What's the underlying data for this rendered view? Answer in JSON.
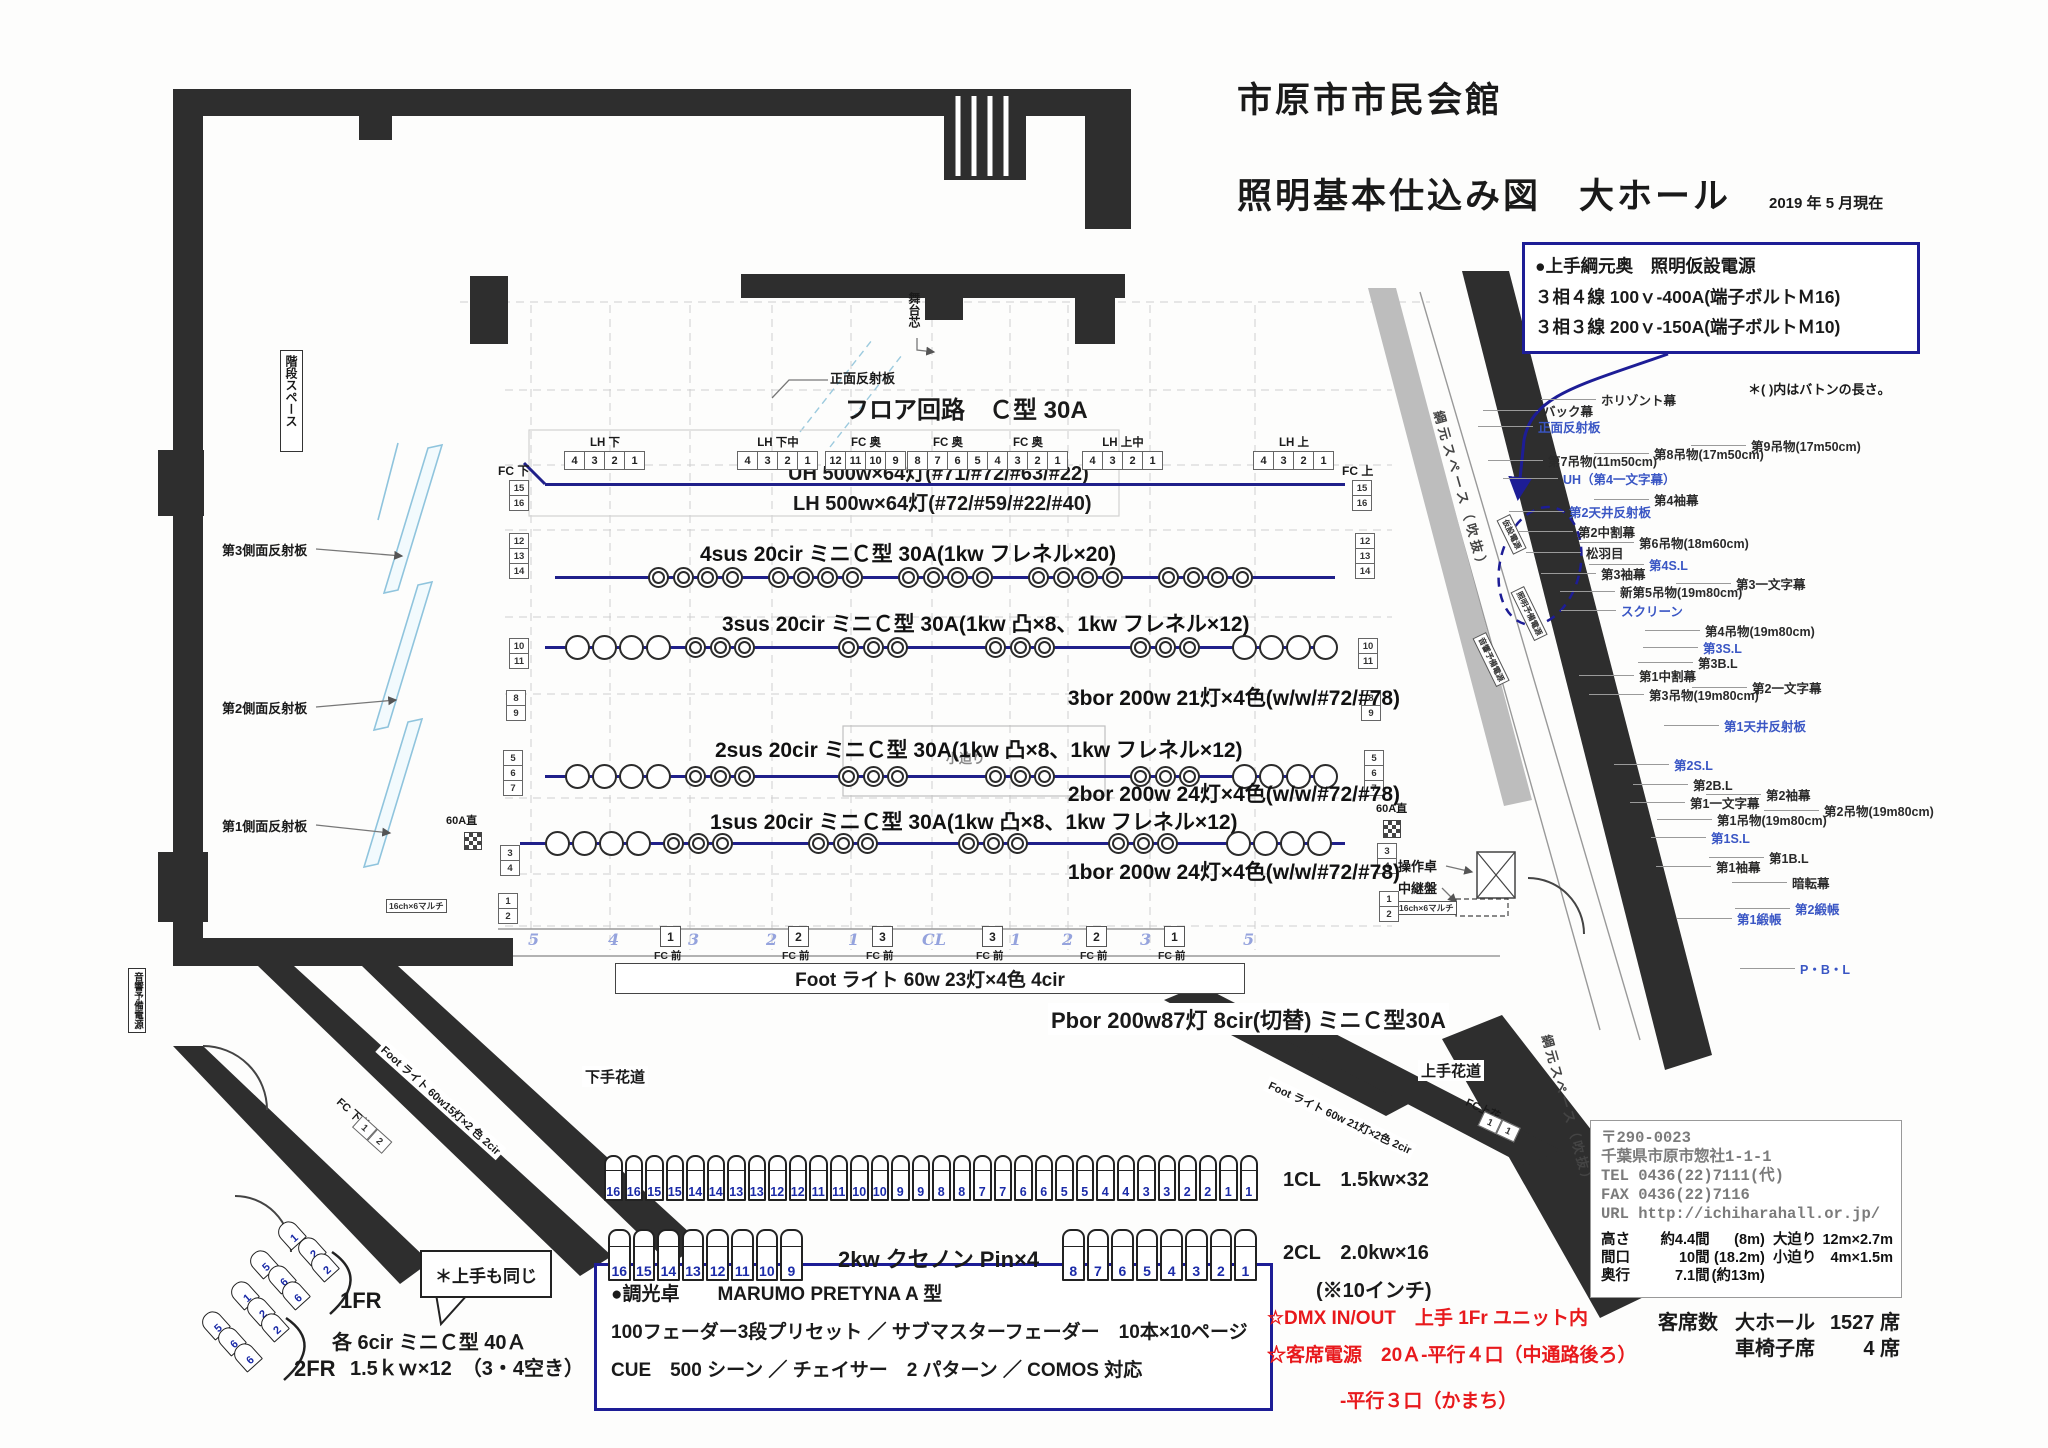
{
  "title": {
    "line1": "市原市市民会館",
    "line2": "照明基本仕込み図　大ホール",
    "date": "2019 年 5 月現在"
  },
  "power_box": {
    "line1": "●上手綱元奥　照明仮設電源",
    "line2": "３相４線 100ｖ-400A(端子ボルトＭ16)",
    "line3": "３相３線 200ｖ-150A(端子ボルトＭ10)"
  },
  "batten_note": "＊( )内はバトンの長さ。",
  "battens": [
    {
      "t": "ホリゾント幕",
      "c": "k"
    },
    {
      "t": "バック幕",
      "c": "k"
    },
    {
      "t": "正面反射板",
      "c": "b"
    },
    {
      "t": "第9吊物(17m50cm)",
      "c": "k"
    },
    {
      "t": "第8吊物(17m50cm)",
      "c": "k"
    },
    {
      "t": "第7吊物(11m50cm)",
      "c": "k"
    },
    {
      "t": "UH（第4一文字幕）",
      "c": "b"
    },
    {
      "t": "第4袖幕",
      "c": "k"
    },
    {
      "t": "第2天井反射板",
      "c": "b"
    },
    {
      "t": "第2中割幕",
      "c": "k"
    },
    {
      "t": "第6吊物(18m60cm)",
      "c": "k"
    },
    {
      "t": "松羽目",
      "c": "k"
    },
    {
      "t": "第4S.L",
      "c": "b"
    },
    {
      "t": "第3袖幕",
      "c": "k"
    },
    {
      "t": "第3一文字幕",
      "c": "k"
    },
    {
      "t": "新第5吊物(19m80cm)",
      "c": "k"
    },
    {
      "t": "スクリーン",
      "c": "b"
    },
    {
      "t": "第4吊物(19m80cm)",
      "c": "k"
    },
    {
      "t": "第3S.L",
      "c": "b"
    },
    {
      "t": "第3B.L",
      "c": "k"
    },
    {
      "t": "第1中割幕",
      "c": "k"
    },
    {
      "t": "第2一文字幕",
      "c": "k"
    },
    {
      "t": "第3吊物(19m80cm)",
      "c": "k"
    },
    {
      "t": "第1天井反射板",
      "c": "b"
    },
    {
      "t": "第2S.L",
      "c": "b"
    },
    {
      "t": "第2B.L",
      "c": "k"
    },
    {
      "t": "第2袖幕",
      "c": "k"
    },
    {
      "t": "第1一文字幕",
      "c": "k"
    },
    {
      "t": "第2吊物(19m80cm)",
      "c": "k"
    },
    {
      "t": "第1吊物(19m80cm)",
      "c": "k"
    },
    {
      "t": "第1S.L",
      "c": "b"
    },
    {
      "t": "第1B.L",
      "c": "k"
    },
    {
      "t": "第1袖幕",
      "c": "k"
    },
    {
      "t": "暗転幕",
      "c": "k"
    },
    {
      "t": "第2緞帳",
      "c": "b"
    },
    {
      "t": "第1緞帳",
      "c": "b"
    },
    {
      "t": "P・B・L",
      "c": "b"
    }
  ],
  "stage": {
    "floor_circuit": "フロア回路　Ｃ型 30A",
    "front_reflector": "正面反射板",
    "stage_center": "舞台芯",
    "fc_down": "FC 下",
    "fc_up": "FC 上",
    "uh_label": "UH 500w×64灯(#71/#72/#63/#22)",
    "lh_label": "LH 500w×64灯(#72/#59/#22/#40)",
    "sus_bars": [
      {
        "label": "4sus 20cir ミニＣ型 30A(1kw フレネル×20)",
        "fixtures": [
          "F4",
          "F4",
          "F4",
          "F4",
          "F4"
        ]
      },
      {
        "label": "3sus 20cir ミニＣ型 30A(1kw 凸×8、1kw フレネル×12)",
        "fixtures": [
          "P4",
          "F3",
          "F3",
          "F3",
          "F3",
          "P4"
        ]
      },
      {
        "label": "2sus 20cir ミニＣ型 30A(1kw 凸×8、1kw フレネル×12)",
        "fixtures": [
          "P4",
          "F3",
          "F3",
          "F3",
          "F3",
          "P4"
        ]
      },
      {
        "label": "1sus 20cir ミニＣ型 30A(1kw 凸×8、1kw フレネル×12)",
        "fixtures": [
          "P4",
          "F3",
          "F3",
          "F3",
          "F3",
          "P4"
        ]
      }
    ],
    "bor_labels": [
      "3bor 200w 21灯×4色(w/w/#72/#78)",
      "2bor 200w 24灯×4色(w/w/#72/#78)",
      "1bor 200w 24灯×4色(w/w/#72/#78)"
    ],
    "channel_groups": [
      {
        "label": "LH 下",
        "cells": [
          "4",
          "3",
          "2",
          "1"
        ]
      },
      {
        "label": "LH 下中",
        "cells": [
          "4",
          "3",
          "2",
          "1"
        ]
      },
      {
        "label": "FC 奥",
        "cells": [
          "12",
          "11",
          "10",
          "9"
        ]
      },
      {
        "label": "FC 奥",
        "cells": [
          "8",
          "7",
          "6",
          "5"
        ]
      },
      {
        "label": "FC 奥",
        "cells": [
          "4",
          "3",
          "2",
          "1"
        ]
      },
      {
        "label": "LH 上中",
        "cells": [
          "4",
          "3",
          "2",
          "1"
        ]
      },
      {
        "label": "LH 上",
        "cells": [
          "4",
          "3",
          "2",
          "1"
        ]
      }
    ],
    "side_stacks": [
      [
        "15",
        "16"
      ],
      [
        "12",
        "13",
        "14"
      ],
      [
        "10",
        "11"
      ],
      [
        "8",
        "9"
      ],
      [
        "5",
        "6",
        "7"
      ],
      [
        "3",
        "4"
      ],
      [
        "1",
        "2"
      ]
    ],
    "scale_row": {
      "items": [
        [
          "b",
          "5"
        ],
        [
          "b",
          "4"
        ],
        [
          "x",
          "1"
        ],
        [
          "b",
          "3"
        ],
        [
          "b",
          "2"
        ],
        [
          "x",
          "2"
        ],
        [
          "b",
          "1"
        ],
        [
          "x",
          "3"
        ],
        [
          "b",
          "CL"
        ],
        [
          "x",
          "3"
        ],
        [
          "b",
          "1"
        ],
        [
          "b",
          "2"
        ],
        [
          "x",
          "2"
        ],
        [
          "b",
          "3"
        ],
        [
          "x",
          "1"
        ],
        [
          "b",
          "5"
        ]
      ],
      "caption": "FC 前"
    },
    "kozeri": "小迫り"
  },
  "misc": {
    "foot_box": "Foot ライト 60w 23灯×4色 4cir",
    "pbor": "Pbor 200w87灯 8cir(切替) ミニＣ型30A",
    "a60": "60A直",
    "multi": "16ch×6マルチ",
    "sosa": "操作卓",
    "chukei": "中継盤",
    "hanamichi_left": "下手花道",
    "hanamichi_right": "上手花道",
    "foot_left": "Foot ライト 60w15灯×2 色 2cir",
    "foot_right": "Foot ライト 60w 21灯×2色 2cir",
    "fc_shimohana": "FC 下花",
    "fc_kamihana": "FC上花",
    "hana_cells_left": [
      "1",
      "2"
    ],
    "hana_cells_right": [
      "1",
      "1"
    ],
    "stairs": "階段スペース",
    "reflectors": [
      "第3側面反射板",
      "第2側面反射板",
      "第1側面反射板"
    ],
    "sound_power": "音響予備電源",
    "light_power": "照明予備電源",
    "temp_power": "仮設電源",
    "tsunamoto": "綱元スペース（吹抜）"
  },
  "fader_rows": {
    "row1": {
      "numbers": [
        "16",
        "16",
        "15",
        "15",
        "14",
        "14",
        "13",
        "13",
        "12",
        "12",
        "11",
        "11",
        "10",
        "10",
        "9",
        "9",
        "8",
        "8",
        "7",
        "7",
        "6",
        "6",
        "5",
        "5",
        "4",
        "4",
        "3",
        "3",
        "2",
        "2",
        "1",
        "1"
      ],
      "label": "1CL　1.5kw×32"
    },
    "row2": {
      "left": [
        "16",
        "15",
        "14",
        "13",
        "12",
        "11",
        "10",
        "9"
      ],
      "mid": "2kw クセノン Pin×4",
      "right": [
        "8",
        "7",
        "6",
        "5",
        "4",
        "3",
        "2",
        "1"
      ],
      "label": "2CL　2.0kw×16",
      "sub": "(※10インチ)"
    }
  },
  "console_box": {
    "line1": "●調光卓　　MARUMO PRETYNA A 型",
    "line2": "100フェーダー3段プリセット ／ サブマスターフェーダー　10本×10ページ",
    "line3": "CUE　500 シーン ／ チェイサー　2 パターン ／ COMOS 対応"
  },
  "red_notes": {
    "line1": "☆DMX IN/OUT　上手 1Fr ユニット内",
    "line2": "☆客席電源　20Ａ-平行４口（中通路後ろ）",
    "line3": "-平行３口（かまち）"
  },
  "venue": {
    "postal": "〒290-0023",
    "address": "千葉県市原市惣社1-1-1",
    "tel": "TEL 0436(22)7111(代)",
    "fax": "FAX 0436(22)7116",
    "url": "URL http://ichiharahall.or.jp/",
    "specs": [
      [
        "高さ",
        "約4.4間",
        "(8m)",
        "大迫り",
        "12m×2.7m"
      ],
      [
        "間口",
        "10間",
        "(18.2m)",
        "小迫り",
        "4m×1.5m"
      ],
      [
        "奥行",
        "7.1間",
        "(約13m)",
        "",
        ""
      ]
    ],
    "seats_label": "客席数",
    "hall": "大ホール",
    "hall_count": "1527 席",
    "wheelchair": "車椅子席",
    "wheelchair_count": "4 席"
  },
  "fr": {
    "label1": "1FR",
    "label2": "2FR",
    "numbers": [
      "1",
      "2",
      "2",
      "5",
      "6",
      "6"
    ],
    "bubble": "＊上手も同じ",
    "note1": "各 6cir ミニＣ型 40Ａ",
    "note2": "1.5ｋｗ×12　（3・4空き）"
  }
}
